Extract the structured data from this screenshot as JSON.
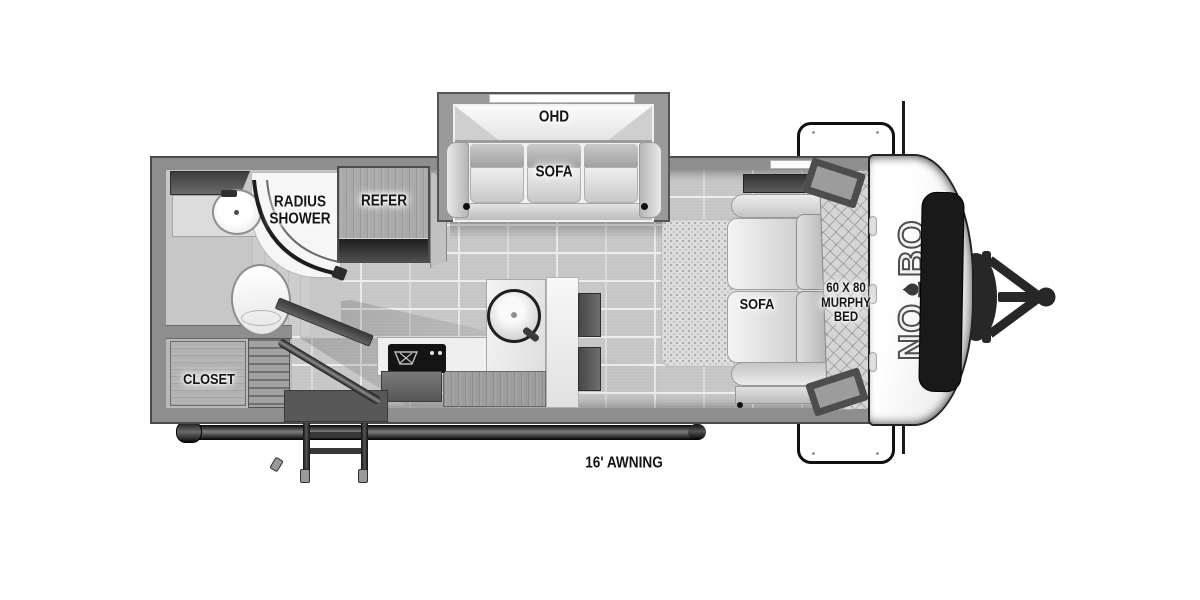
{
  "floorplan": {
    "title": "NO BO travel trailer floor plan",
    "labels": {
      "ohd": "OHD",
      "slide_sofa": "SOFA",
      "radius_shower": [
        "RADIUS",
        "SHOWER"
      ],
      "refer": "REFER",
      "closet": "CLOSET",
      "bedroom_sofa": "SOFA",
      "murphy_bed": [
        "60 X 80",
        "MURPHY",
        "BED"
      ],
      "awning": "16' AWNING"
    },
    "brand": {
      "prefix": "NO",
      "suffix": "BO",
      "icon": "campfire-icon"
    },
    "colors": {
      "wall": "#8e8e8e",
      "floor": "#c6c6c6",
      "carpet": "#e1e1e1",
      "counter": "#efefef",
      "dark_fixture": "#272727",
      "white": "#ffffff"
    }
  }
}
